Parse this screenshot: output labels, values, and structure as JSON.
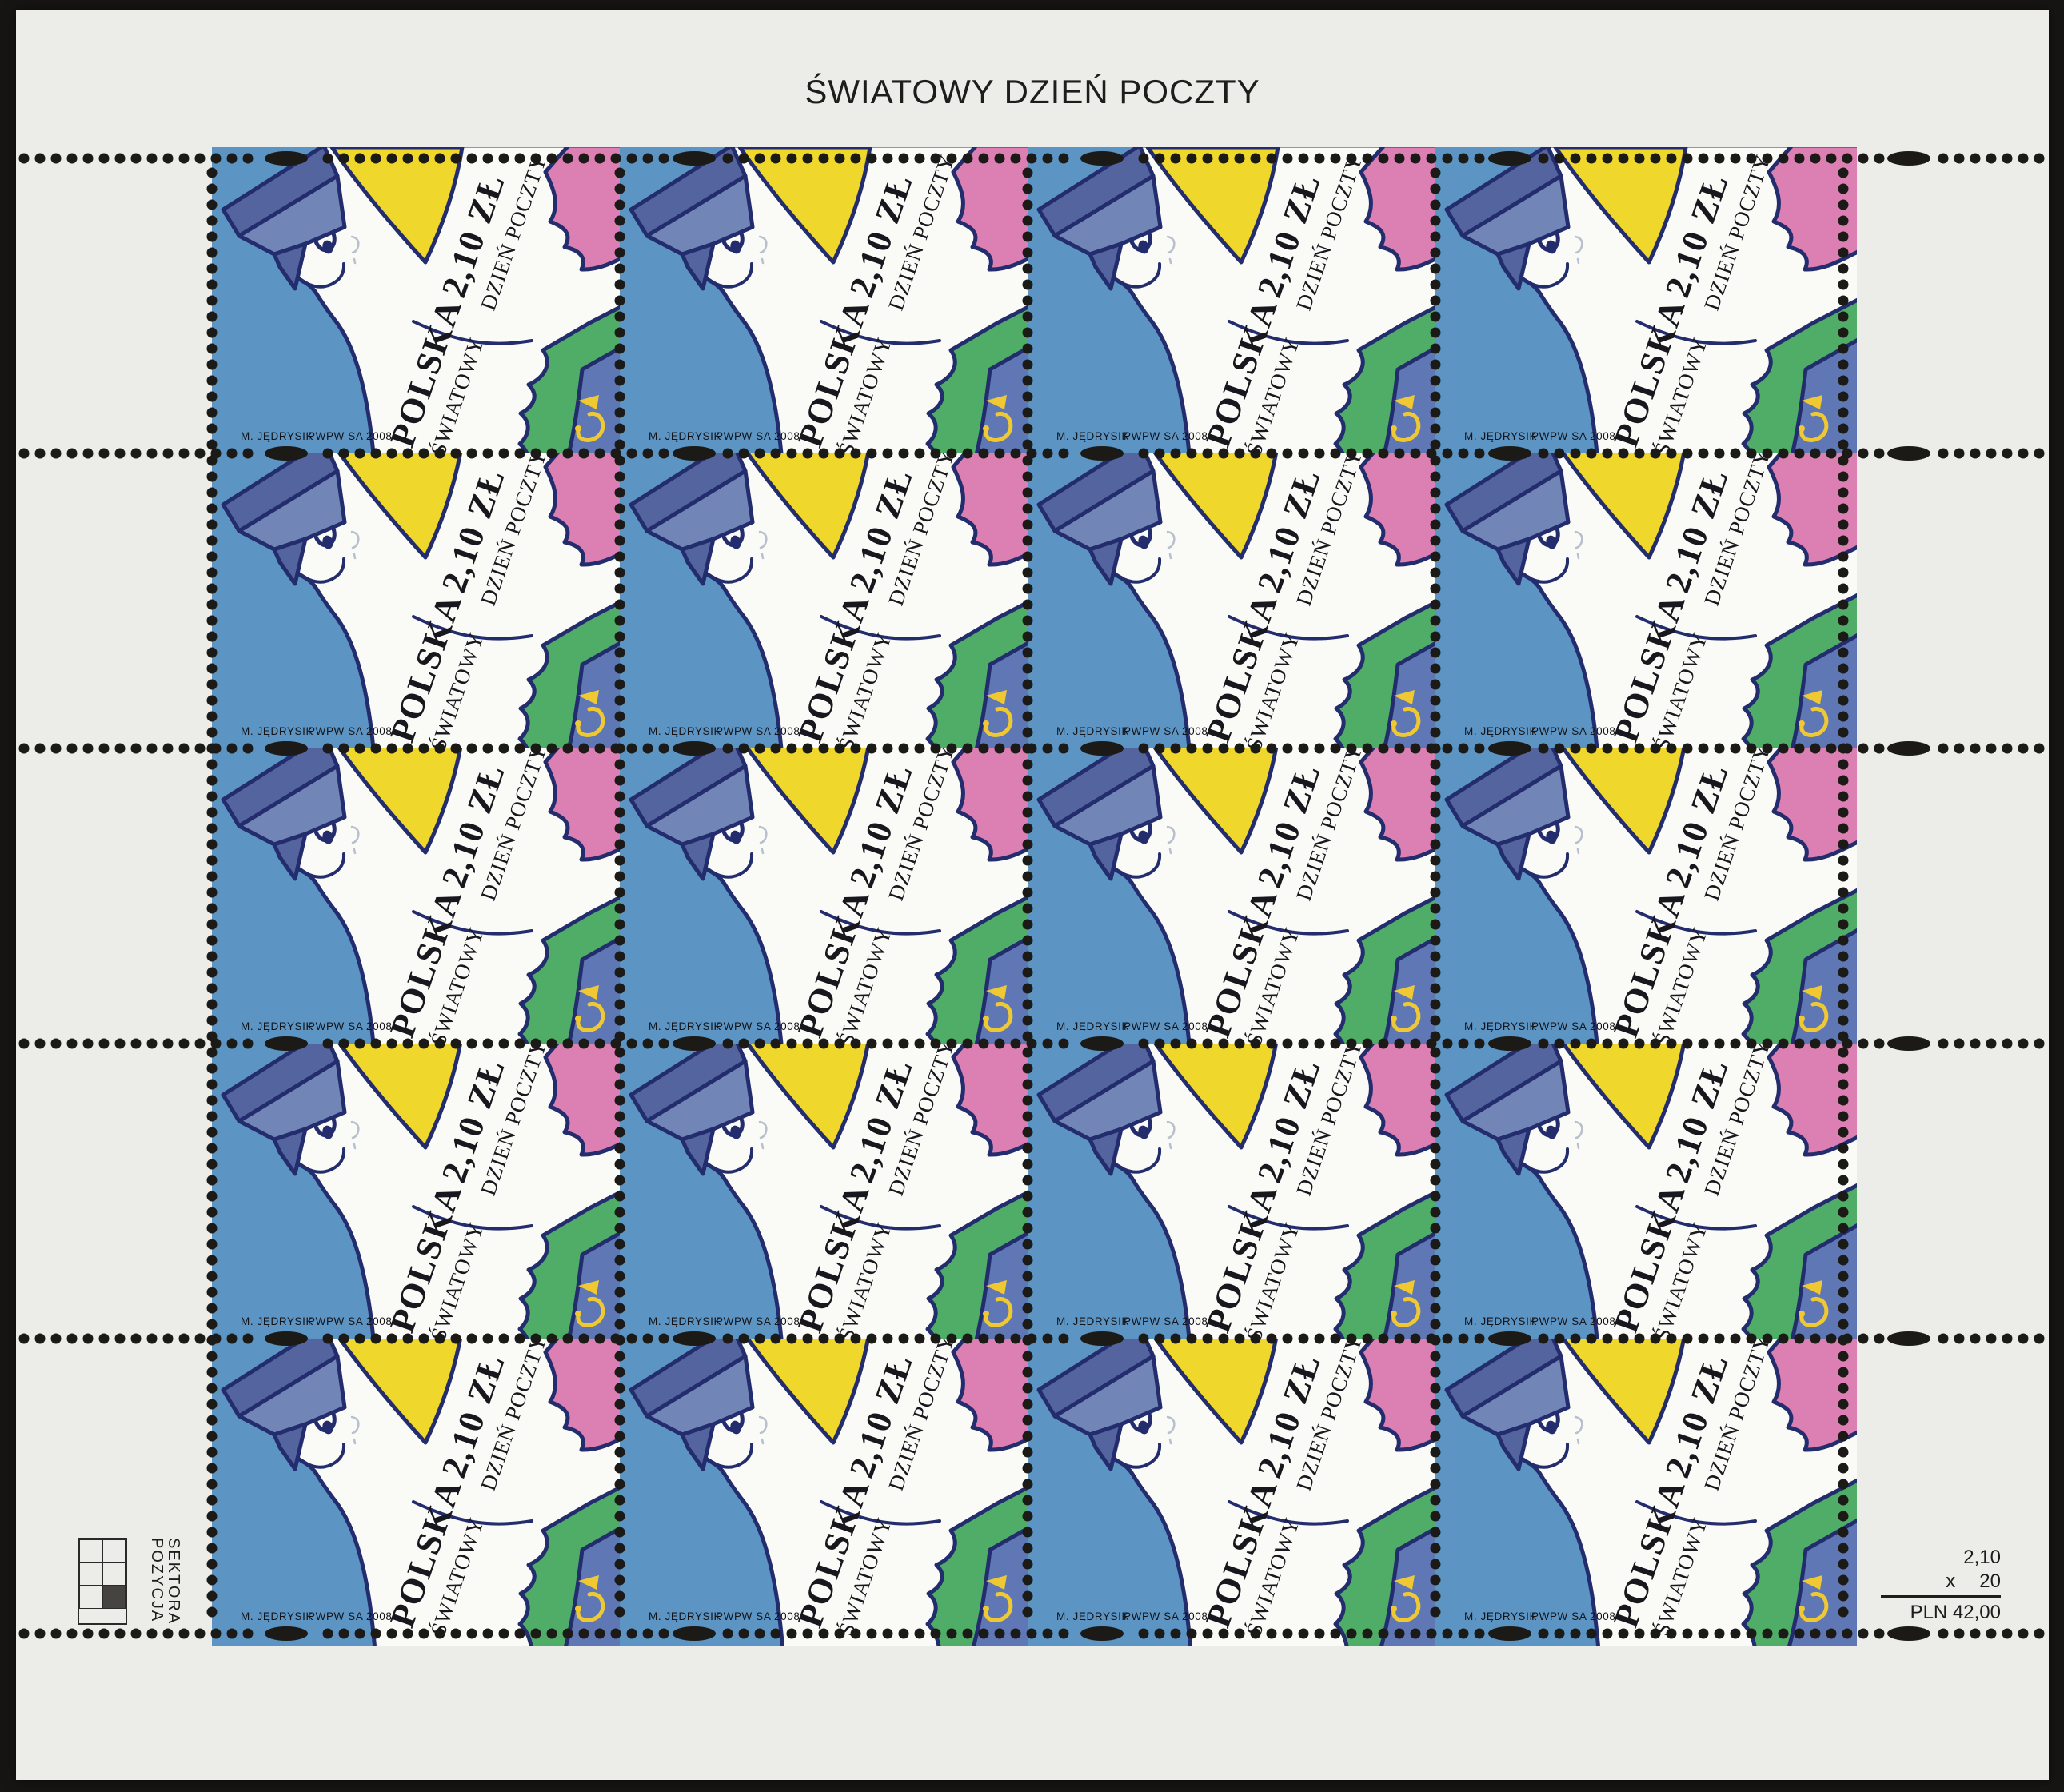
{
  "sheet": {
    "title": "ŚWIATOWY DZIEŃ POCZTY",
    "stamp": {
      "country": "POLSKA",
      "denomination": "2,10 ZŁ",
      "occasion_line1": "ŚWIATOWY",
      "occasion_line2": "DZIEŃ POCZTY",
      "designer": "M. JĘDRYSIK",
      "printer": "PWPW SA 2008"
    },
    "grid": {
      "columns": 4,
      "rows": 5,
      "stamp_count": 20
    },
    "sector_marker": {
      "label_line1": "POZYCJA",
      "label_line2": "SEKTORA",
      "grid_columns": 2,
      "grid_rows": 3,
      "filled_cell": "bottom-right"
    },
    "price_calc": {
      "unit_price": "2,10",
      "multiply_sign": "x",
      "quantity": "20",
      "total": "PLN 42,00"
    },
    "colors": {
      "scan_background": "#161513",
      "paper": "#ECECE8",
      "stamp_blue": "#5C95C4",
      "outline_navy": "#232D6E",
      "cap_dark": "#54649E",
      "cap_light": "#7285B7",
      "yellow": "#EFD72B",
      "pink": "#DC7FB2",
      "green": "#4FAD68",
      "band_blue": "#5F78B5",
      "horn_yellow": "#EFC832",
      "ink": "#1D1D1B"
    }
  }
}
